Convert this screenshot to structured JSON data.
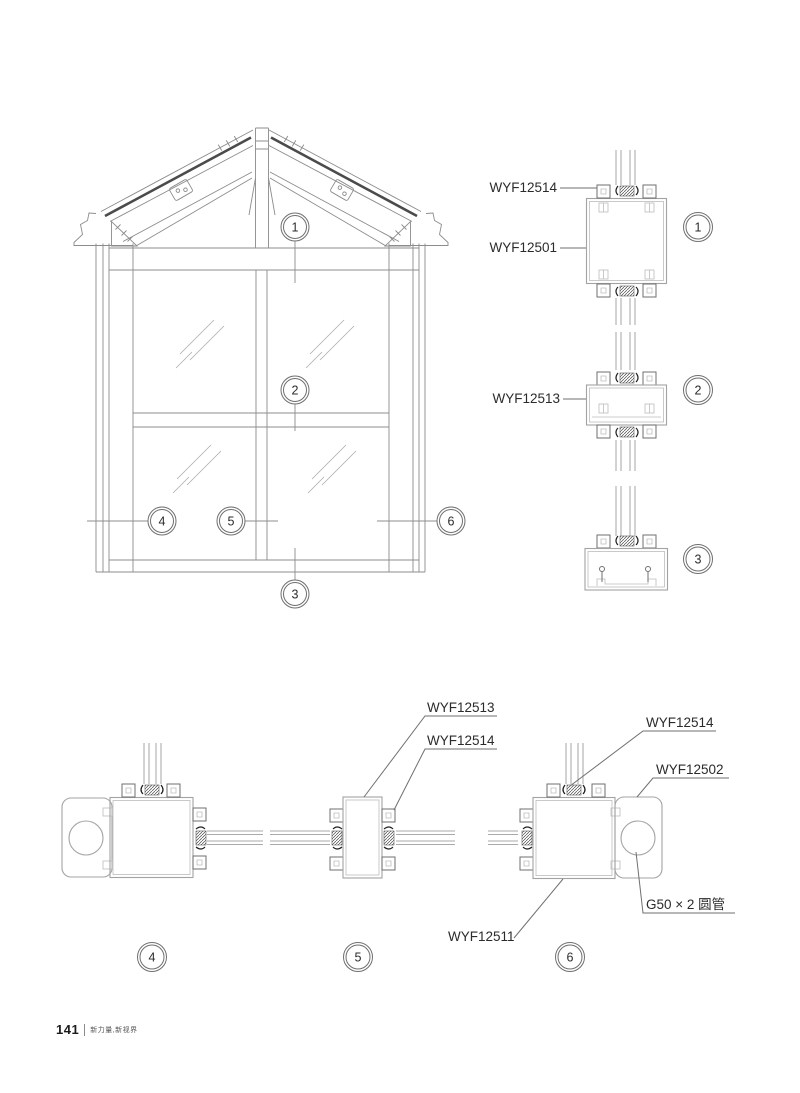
{
  "footer": {
    "page_number": "141",
    "tagline": "新力量,新视界"
  },
  "labels": {
    "section1_cap": "WYF12514",
    "section1_body": "WYF12501",
    "section2_body": "WYF12513",
    "plan_mid_body": "WYF12513",
    "plan_mid_cap": "WYF12514",
    "plan_right_cap": "WYF12514",
    "plan_right_end": "WYF12502",
    "plan_tube": "G50 × 2 圆管",
    "plan_right_body": "WYF12511"
  },
  "callouts": {
    "c1": "1",
    "c2": "2",
    "c3": "3",
    "c4": "4",
    "c5": "5",
    "c6": "6"
  }
}
